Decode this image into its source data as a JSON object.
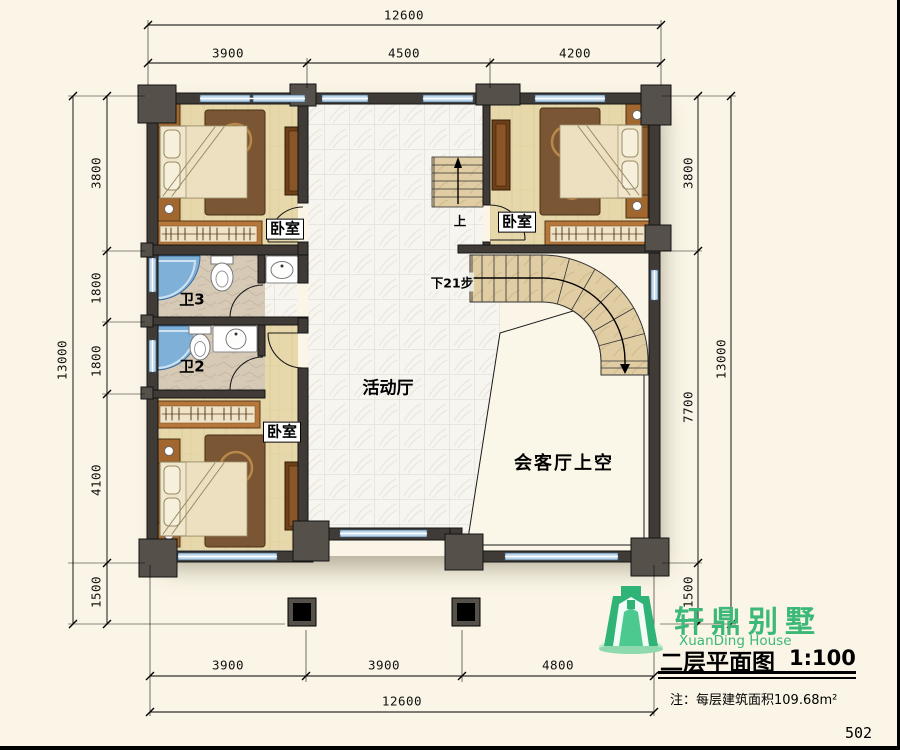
{
  "page": {
    "number": "502"
  },
  "branding": {
    "name_cn": "轩鼎别墅",
    "name_en": "XuanDing House"
  },
  "titleblock": {
    "title": "二层平面图",
    "scale": "1:100",
    "note": "注：每层建筑面积109.68m²"
  },
  "dimensions": {
    "top": {
      "total": "12600",
      "segments": [
        "3900",
        "4500",
        "4200"
      ]
    },
    "bottom": {
      "total": "12600",
      "segments": [
        "3900",
        "3900",
        "4800"
      ]
    },
    "left": {
      "total": "13000",
      "segments": [
        "3800",
        "1800",
        "1800",
        "4100",
        "1500"
      ]
    },
    "right": {
      "total": "13000",
      "segments": [
        "3800",
        "7700",
        "1500"
      ]
    }
  },
  "rooms": {
    "bedroom_top_left": "卧室",
    "bedroom_top_right": "卧室",
    "bedroom_bottom": "卧室",
    "bath_3": "卫3",
    "bath_2": "卫2",
    "activity_hall": "活动厅",
    "living_room_void": "会客厅上空"
  },
  "stairs": {
    "up_label": "上",
    "down_label": "下21步"
  },
  "colors": {
    "paper": "#faf5e6",
    "wall": "#403b36",
    "wall_edge": "#141414",
    "pilaster": "#55504a",
    "glass": "#bdd8ec",
    "wood_floor": "#e7d8ab",
    "stone_floor": "#d6cab7",
    "tile_floor": "#f7f5f0",
    "stair": "#e0cda4",
    "rug": "#7a5634",
    "furniture_brown": "#a2672f",
    "bath_blue": "#7fb0d8",
    "logo_green": "#2fb377",
    "text_green": "#3cb878",
    "ink": "#111111"
  }
}
